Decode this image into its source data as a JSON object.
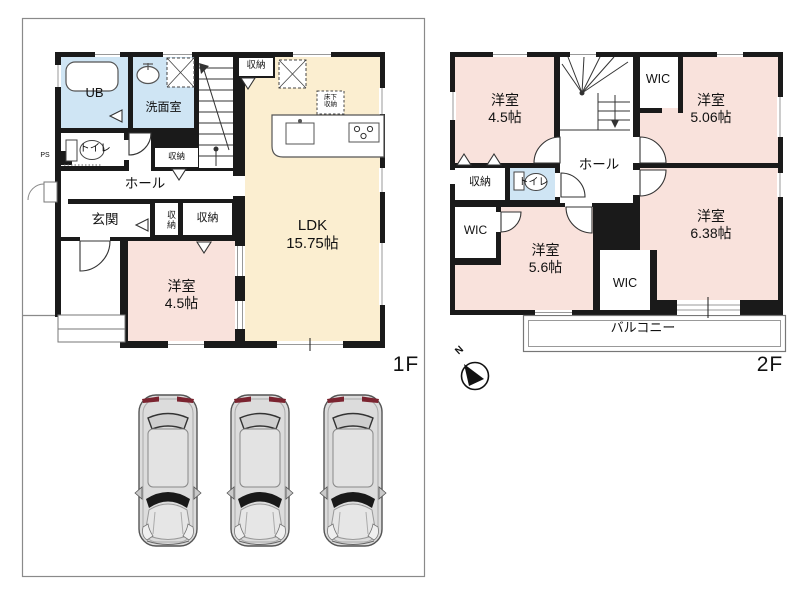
{
  "colors": {
    "wall": "#1a1a1a",
    "pink": "#f9e2dc",
    "cream": "#fbeed0",
    "blue": "#cfe5f4",
    "line_gray": "#8a8a8a",
    "car_body": "#dcdcdc"
  },
  "compass": {
    "north_label": "N"
  },
  "floor1": {
    "floor_label": "1F",
    "rooms": {
      "ub": {
        "label": "UB"
      },
      "washroom": {
        "label": "洗面室"
      },
      "toilet": {
        "label": "トイレ"
      },
      "ps": {
        "label": "PS"
      },
      "hall": {
        "label": "ホール"
      },
      "entrance": {
        "label": "玄関"
      },
      "storage_under_stairs": {
        "label": "収納"
      },
      "storage_vertical": {
        "label": "収納"
      },
      "storage_entrance": {
        "label": "収納"
      },
      "storage_ldk": {
        "label": "収納"
      },
      "underfloor_storage": {
        "line1": "床下",
        "line2": "収納"
      },
      "ldk": {
        "name": "LDK",
        "size": "15.75帖"
      },
      "bedroom": {
        "name": "洋室",
        "size": "4.5帖"
      }
    }
  },
  "floor2": {
    "floor_label": "2F",
    "rooms": {
      "bedroom_45": {
        "name": "洋室",
        "size": "4.5帖"
      },
      "bedroom_506": {
        "name": "洋室",
        "size": "5.06帖"
      },
      "bedroom_56": {
        "name": "洋室",
        "size": "5.6帖"
      },
      "bedroom_638": {
        "name": "洋室",
        "size": "6.38帖"
      },
      "wic_top": {
        "label": "WIC"
      },
      "wic_left": {
        "label": "WIC"
      },
      "wic_bottom": {
        "label": "WIC"
      },
      "hall": {
        "label": "ホール"
      },
      "storage": {
        "label": "収納"
      },
      "toilet": {
        "label": "トイレ"
      },
      "balcony": {
        "label": "バルコニー"
      }
    }
  }
}
